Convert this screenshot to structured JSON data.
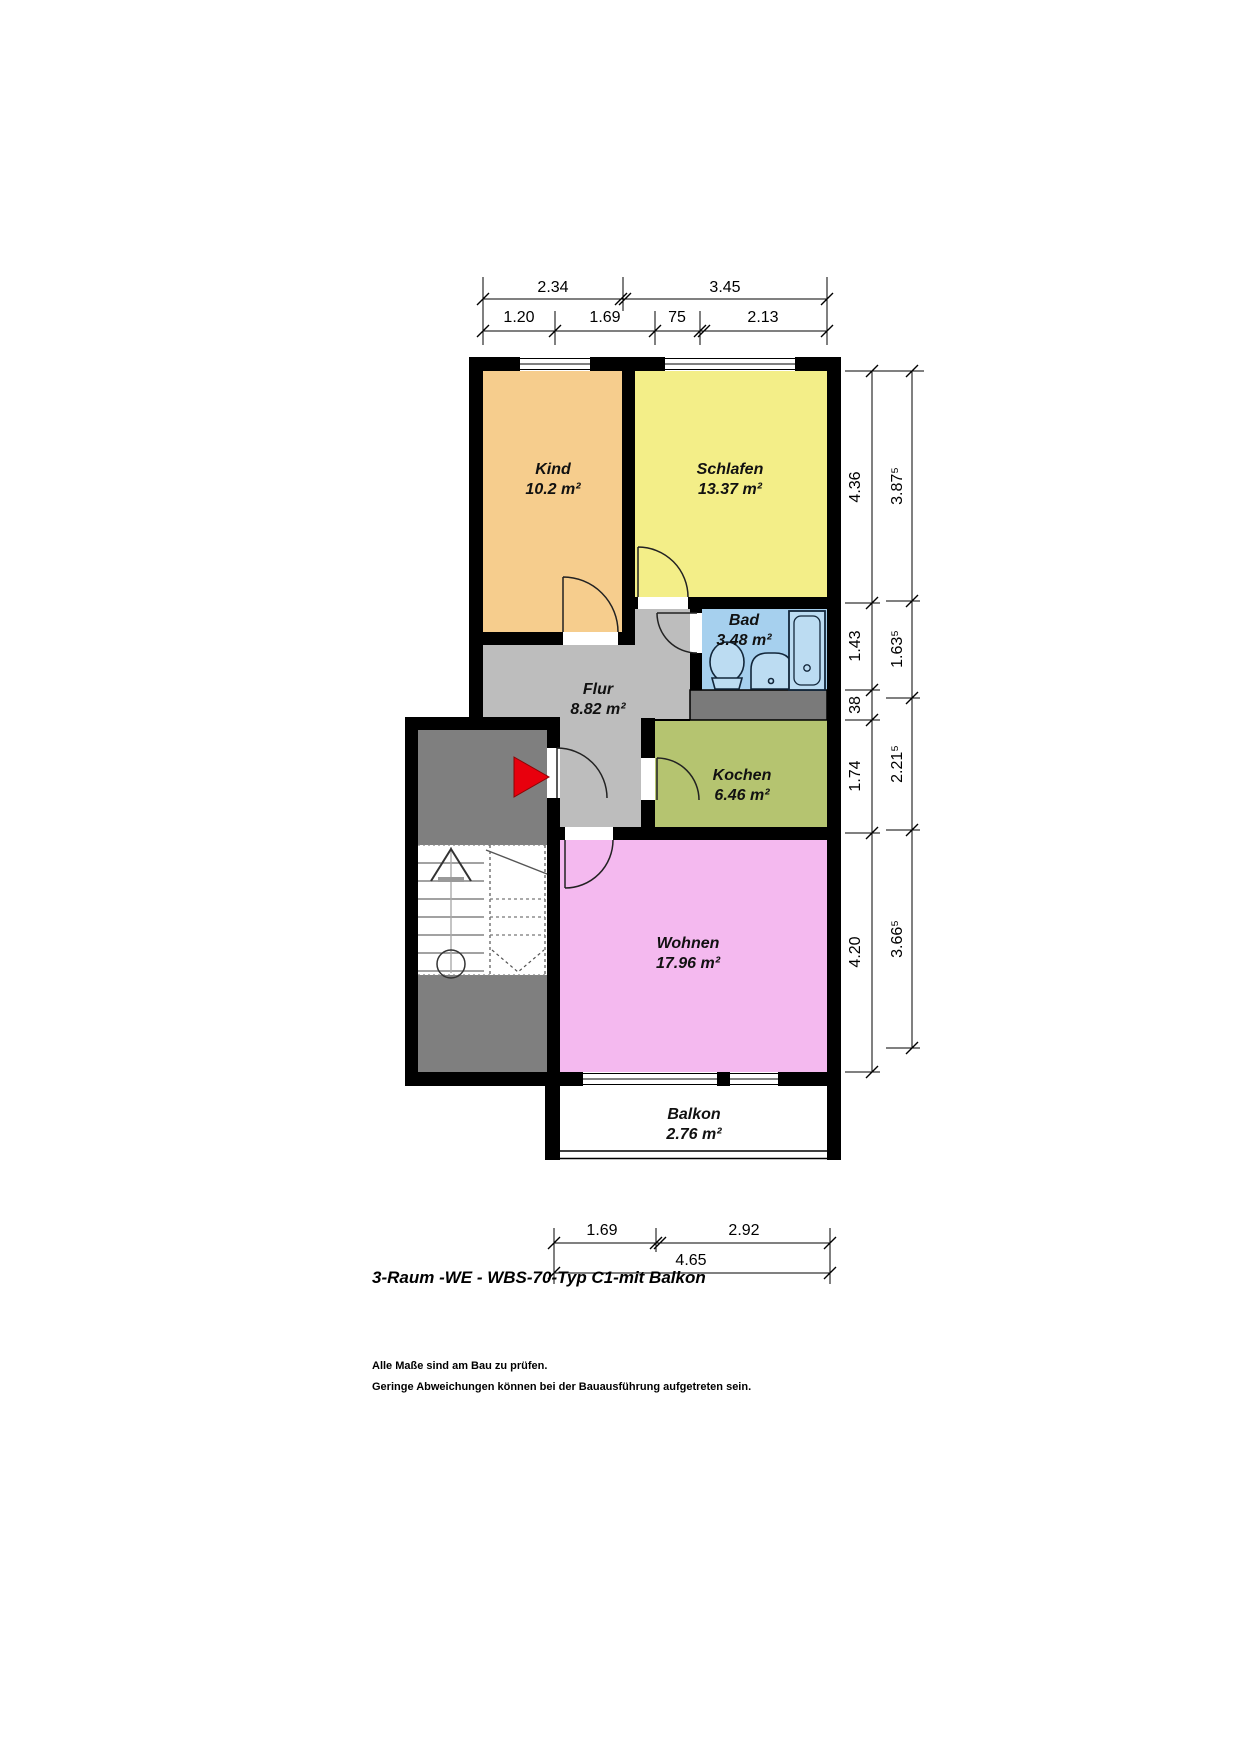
{
  "title": "3-Raum -WE - WBS-70-Typ C1-mit Balkon",
  "notes": {
    "line1": "Alle Maße sind am Bau zu prüfen.",
    "line2": "Geringe Abweichungen können bei der Bauausführung aufgetreten sein."
  },
  "rooms": [
    {
      "name": "Kind",
      "area": "10.2 m²"
    },
    {
      "name": "Schlafen",
      "area": "13.37 m²"
    },
    {
      "name": "Bad",
      "area": "3.48 m²"
    },
    {
      "name": "Flur",
      "area": "8.82 m²"
    },
    {
      "name": "Kochen",
      "area": "6.46 m²"
    },
    {
      "name": "Wohnen",
      "area": "17.96 m²"
    },
    {
      "name": "Balkon",
      "area": "2.76 m²"
    }
  ],
  "dimensions": {
    "top_row1": [
      "2.34",
      "3.45"
    ],
    "top_row2": [
      "1.20",
      "1.69",
      "75",
      "2.13"
    ],
    "right_inner": [
      "4.36",
      "1.43",
      "38",
      "1.74",
      "4.20"
    ],
    "right_outer": [
      "3.87⁵",
      "1.63⁵",
      "2.21⁵",
      "3.66⁵"
    ],
    "bottom_row1": [
      "1.69",
      "2.92"
    ],
    "bottom_row2": [
      "4.65"
    ]
  },
  "colors": {
    "wall": "#000000",
    "kind": "#f6cd8d",
    "schlafen": "#f3ee88",
    "bad": "#a6d0ee",
    "flur": "#bdbdbd",
    "kochen": "#b5c470",
    "wohnen": "#f4b9ef",
    "stairwell": "#7f7f7f",
    "shaft": "#7a7a7a",
    "fixture": "#bcdcf2",
    "entrance_arrow": "#e8000d"
  }
}
